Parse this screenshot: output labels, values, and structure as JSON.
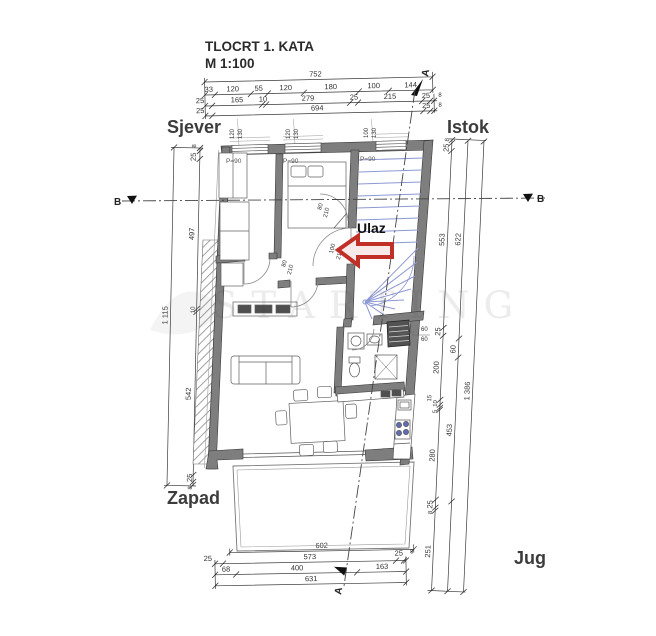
{
  "title": {
    "line1": "TLOCRT 1. KATA",
    "line2": "M 1:100"
  },
  "compass": {
    "north": "Sjever",
    "east": "Istok",
    "west": "Zapad",
    "south": "Jug"
  },
  "entrance_label": "Ulaz",
  "section_marks": {
    "a": "A",
    "b": "B"
  },
  "watermark": "STARTING",
  "parapet_label": "P=90",
  "windows": [
    {
      "w": "120",
      "h": "130"
    },
    {
      "w": "120",
      "h": "130"
    },
    {
      "w": "100",
      "h": "130"
    }
  ],
  "doors": {
    "entrance": {
      "w": "100",
      "h": "210"
    },
    "interior": {
      "w": "80",
      "h": "210"
    }
  },
  "shaft": {
    "w": "60",
    "h": "60"
  },
  "dims": {
    "top": {
      "total": "752",
      "row2": [
        "33",
        "120",
        "55",
        "120",
        "180",
        "100",
        "144"
      ],
      "row3": [
        "25",
        "165",
        "10",
        "279",
        "25",
        "215",
        "25",
        "8"
      ],
      "row4": [
        "25",
        "694",
        "25",
        "8"
      ]
    },
    "left": {
      "total": "1 115",
      "chain": [
        "8",
        "25",
        "497",
        "10",
        "542",
        "25",
        "8"
      ]
    },
    "right": {
      "total": "1 386",
      "chain_inner": [
        "8",
        "25",
        "553",
        "25",
        "200",
        "15",
        "10",
        "5",
        "280",
        "25",
        "8",
        "251"
      ],
      "chain_mid": [
        "622",
        "60",
        "453"
      ]
    },
    "bottom": {
      "terrace": "602",
      "row2": [
        "25",
        "573",
        "25",
        "8"
      ],
      "row3": [
        "68",
        "400",
        "163"
      ],
      "total": "631"
    }
  },
  "colors": {
    "wall": "#7e7e7e",
    "stairs": "#8d98d4",
    "arrow": "#c03026"
  }
}
